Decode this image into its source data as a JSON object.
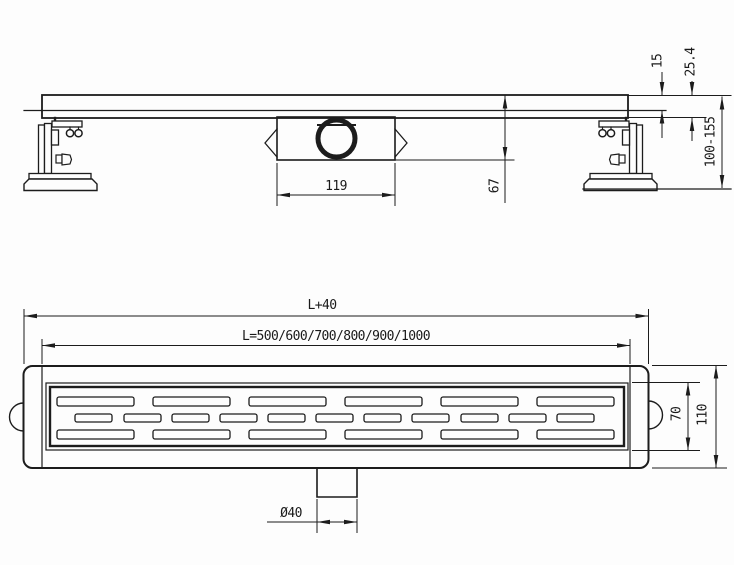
{
  "colors": {
    "ink": "#1c1c1c",
    "paper": "#fdfdfd"
  },
  "side_view": {
    "dims": {
      "grate_thickness": "15",
      "edge_height": "25.4",
      "install_height": "100-155",
      "total_depth": "67",
      "trap_length": "119"
    }
  },
  "plan_view": {
    "dims": {
      "overall_length": "L+40",
      "channel_lengths": "L=500/600/700/800/900/1000",
      "grate_width": "70",
      "body_width": "110",
      "outlet_diameter": "Ø40"
    }
  }
}
